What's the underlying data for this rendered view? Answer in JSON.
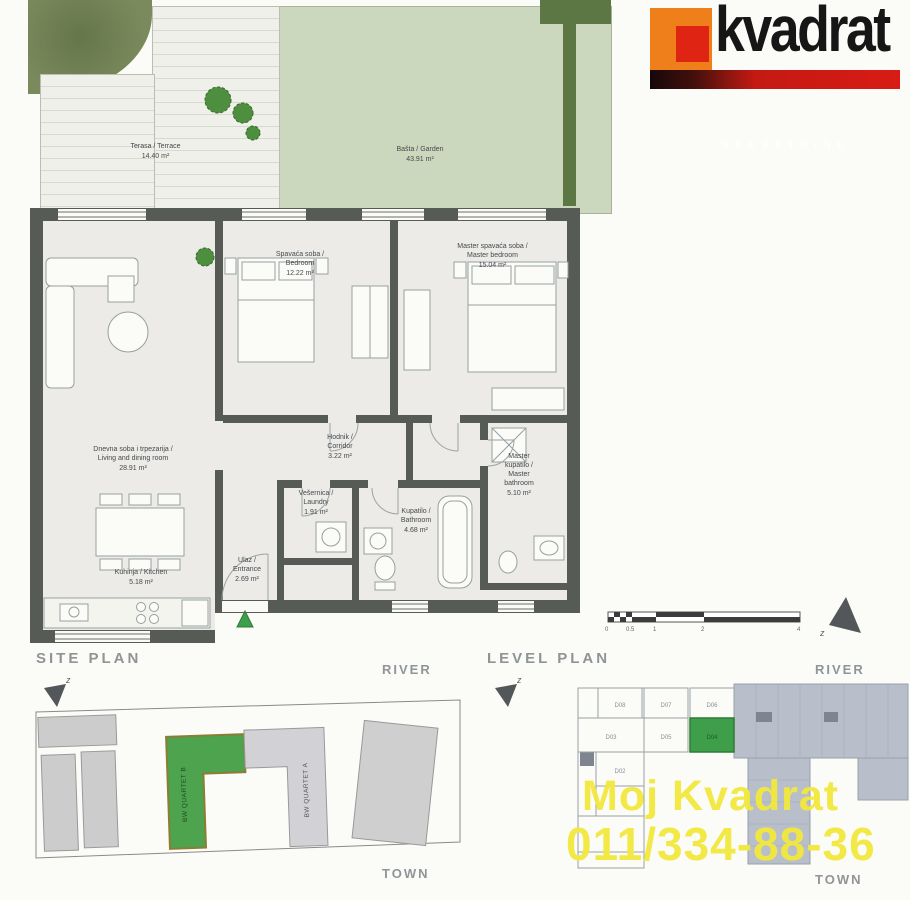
{
  "logo": {
    "brand": "kvadrat",
    "tagline": "NEKRETNINE"
  },
  "outdoor": {
    "terrace": {
      "name": "Terasa / Terrace",
      "area": "14.40 m²"
    },
    "garden": {
      "name": "Bašta / Garden",
      "area": "43.91 m²"
    }
  },
  "rooms": {
    "bedroom": {
      "name": "Spavaća soba /\nBedroom",
      "area": "12.22 m²"
    },
    "master_bedroom": {
      "name": "Master spavaća soba /\nMaster bedroom",
      "area": "15.04 m²"
    },
    "living": {
      "name": "Dnevna soba i trpezarija /\nLiving and dining room",
      "area": "28.91 m²"
    },
    "corridor": {
      "name": "Hodnik /\nCorridor",
      "area": "3.22 m²"
    },
    "laundry": {
      "name": "Vešernica /\nLaundry",
      "area": "1.91 m²"
    },
    "bathroom": {
      "name": "Kupatilo /\nBathroom",
      "area": "4.68 m²"
    },
    "master_bathroom": {
      "name": "Master\nkupatilo /\nMaster\nbathroom",
      "area": "5.10 m²"
    },
    "kitchen": {
      "name": "Kuhinja / Kitchen",
      "area": "5.18 m²"
    },
    "entrance": {
      "name": "Ulaz /\nEntrance",
      "area": "2.69 m²"
    }
  },
  "scale_bar": {
    "ticks": [
      "0",
      "0.5",
      "1",
      "2",
      "4"
    ]
  },
  "compass_label": "z",
  "site_plan": {
    "title": "SITE PLAN",
    "river": "RIVER",
    "town": "TOWN",
    "building_b": "BW QUARTET B",
    "building_a": "BW QUARTET A"
  },
  "level_plan": {
    "title": "LEVEL PLAN",
    "river": "RIVER",
    "town": "TOWN",
    "units": [
      "D08",
      "D07",
      "D06",
      "D05",
      "D04",
      "D03",
      "D02"
    ]
  },
  "watermark": {
    "line1": "Moj Kvadrat",
    "line2": "011/334-88-36"
  },
  "colors": {
    "wall": "#575b55",
    "accent_green": "#3da04b",
    "garden_green": "#ccd8bd",
    "hedge_green": "#5d7744",
    "logo_orange": "#ef7f1a",
    "logo_red": "#d81b15",
    "watermark_yellow": "#f2e93d"
  }
}
